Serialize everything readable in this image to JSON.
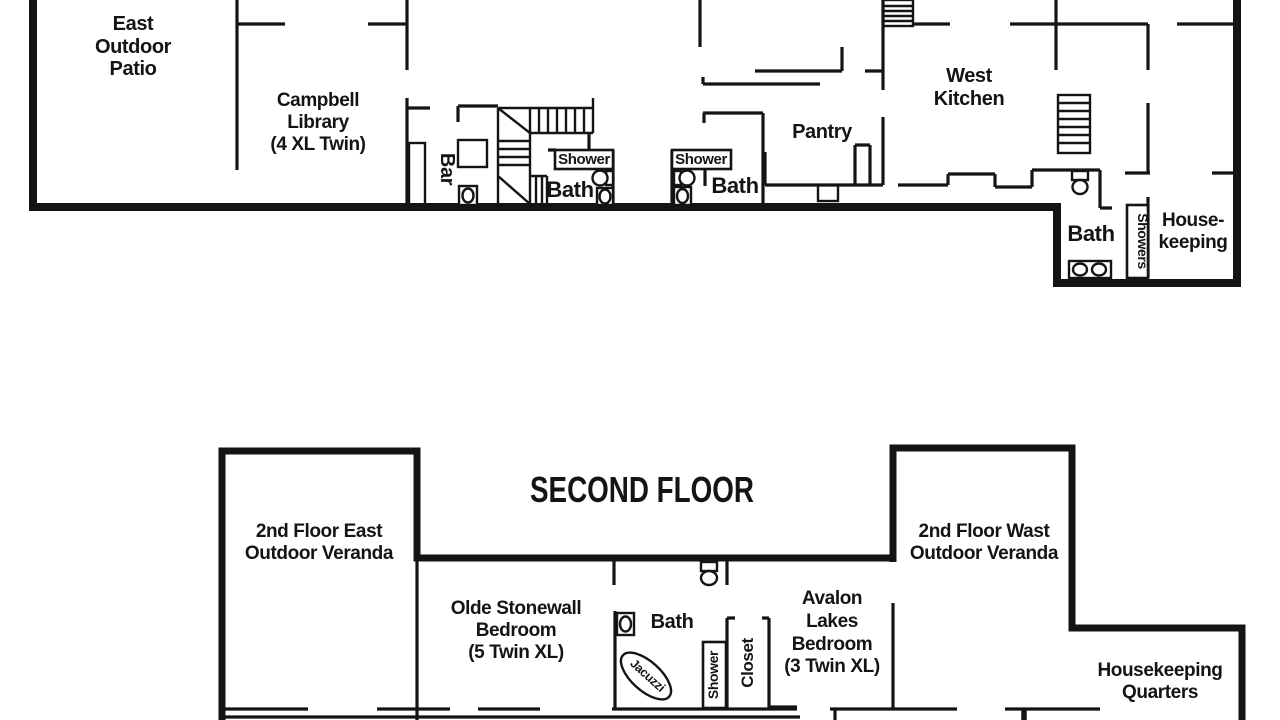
{
  "page": {
    "background": "#ffffff",
    "line_color": "#141414"
  },
  "first_floor": {
    "patio_lines": [
      "East",
      "Outdoor",
      "Patio"
    ],
    "library_lines": [
      "Campbell",
      "Library",
      "(4 XL Twin)"
    ],
    "bar": "Bar",
    "shower_a": "Shower",
    "bath_a": "Bath",
    "shower_b": "Shower",
    "bath_b": "Bath",
    "pantry": "Pantry",
    "kitchen_lines": [
      "West",
      "Kitchen"
    ],
    "bath_c": "Bath",
    "showers": "Showers",
    "housekeeping_lines": [
      "House-",
      "keeping"
    ]
  },
  "second_floor": {
    "title": "SECOND FLOOR",
    "veranda_east_lines": [
      "2nd Floor East",
      "Outdoor Veranda"
    ],
    "veranda_west_lines": [
      "2nd Floor Wast",
      "Outdoor Veranda"
    ],
    "stonewall_lines": [
      "Olde Stonewall",
      "Bedroom",
      "(5 Twin XL)"
    ],
    "avalon_lines": [
      "Avalon",
      "Lakes",
      "Bedroom",
      "(3 Twin XL)"
    ],
    "bath": "Bath",
    "jacuzzi": "Jacuzzi",
    "shower": "Shower",
    "closet": "Closet",
    "housekeeping_lines": [
      "Housekeeping",
      "Quarters"
    ]
  }
}
